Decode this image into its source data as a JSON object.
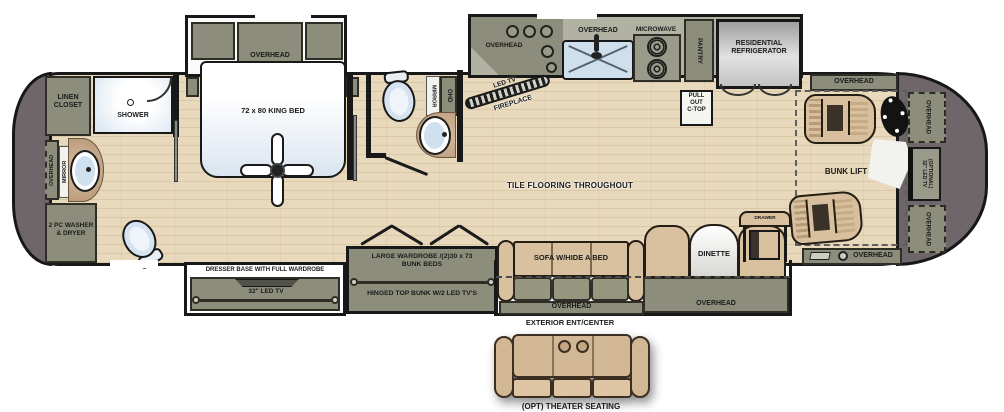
{
  "title": "RV floor plan",
  "colors": {
    "cabinet_olive": "#8d8d7b",
    "floor_wood": "#e8d9bc",
    "upholstery_tan": "#d9c1a0",
    "end_caps_gray": "#6f6669",
    "fixture_blue": "#d5e3f0",
    "wall_black": "#181818"
  },
  "labels": {
    "flooring": "TILE FLOORING THROUGHOUT",
    "rear_bath": {
      "linen": "LINEN\nCLOSET",
      "shower": "SHOWER",
      "overhead_vert": "OVERHEAD",
      "mirror_vert": "MIRROR",
      "washer": "2 PC WASHER\n& DRYER"
    },
    "bedroom": {
      "overhead": "OVERHEAD",
      "bed": "72 x 80 KING BED",
      "dresser_base": "DRESSER BASE WITH FULL WARDROBE",
      "tv32": "32\" LED TV"
    },
    "mid_bath": {
      "mirror_vert": "MIRROR",
      "ohd_vert": "OHD"
    },
    "kitchen": {
      "corner_overhead": "OVERHEAD",
      "led_tv": "LED TV",
      "fireplace": "FIREPLACE",
      "sink_overhead": "OVERHEAD",
      "microwave": "MICROWAVE",
      "pantry_vert": "PANTRY",
      "pull_out_ctop": "PULL\nOUT\nC-TOP",
      "refrigerator": "RESIDENTIAL\nREFRIGERATOR"
    },
    "living": {
      "bunk_line1": "LARGE WARDROBE /(2)30 x 73\nBUNK BEDS",
      "bunk_line2": "HINGED TOP BUNK  W/2  LED TV'S",
      "sofa": "SOFA W/HIDE A BED",
      "sofa_overhead": "OVERHEAD",
      "exterior_center": "EXTERIOR ENT/CENTER",
      "dinette": "DINETTE",
      "dinette_overhead": "OVERHEAD",
      "drawer": "DRAWER"
    },
    "front": {
      "overhead_top": "OVERHEAD",
      "bunk_lift": "BUNK LIFT",
      "overhead_right_upper": "OVERHEAD",
      "optional_tv": "(OPTIONAL)\n32\" LED TV",
      "overhead_right_lower": "OVERHEAD",
      "overhead_bottom": "OVERHEAD"
    },
    "optional": {
      "theater": "(OPT) THEATER SEATING"
    }
  }
}
